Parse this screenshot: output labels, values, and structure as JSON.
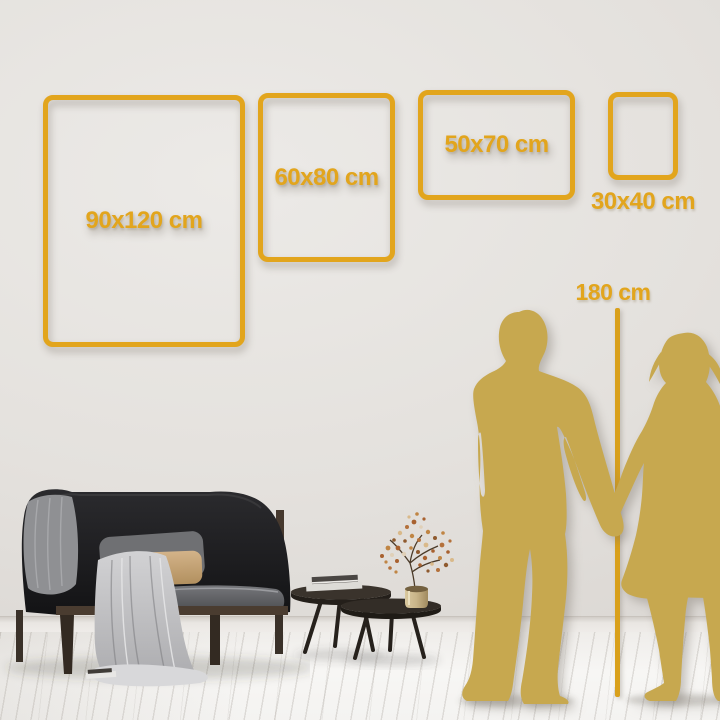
{
  "size_guide": {
    "frames": [
      {
        "label": "90x120 cm",
        "width_cm": 90,
        "height_cm": 120
      },
      {
        "label": "60x80 cm",
        "width_cm": 60,
        "height_cm": 80
      },
      {
        "label": "50x70 cm",
        "width_cm": 50,
        "height_cm": 70
      },
      {
        "label": "30x40 cm",
        "width_cm": 30,
        "height_cm": 40
      }
    ],
    "height_reference": {
      "label": "180 cm",
      "value_cm": 180
    }
  },
  "colors": {
    "frame_gold": "#E2A51D",
    "silhouette_gold": "#C7A84F",
    "measure_line_gold": "#D9A01B",
    "wall": "#E4E1DD",
    "floor": "#F6F5F3"
  },
  "scene": {
    "objects": [
      "sofa",
      "throw-blanket",
      "pillows",
      "nesting-coffee-tables",
      "books",
      "brass-vase-with-dried-flowers",
      "man-silhouette",
      "woman-silhouette",
      "measuring-line"
    ]
  }
}
